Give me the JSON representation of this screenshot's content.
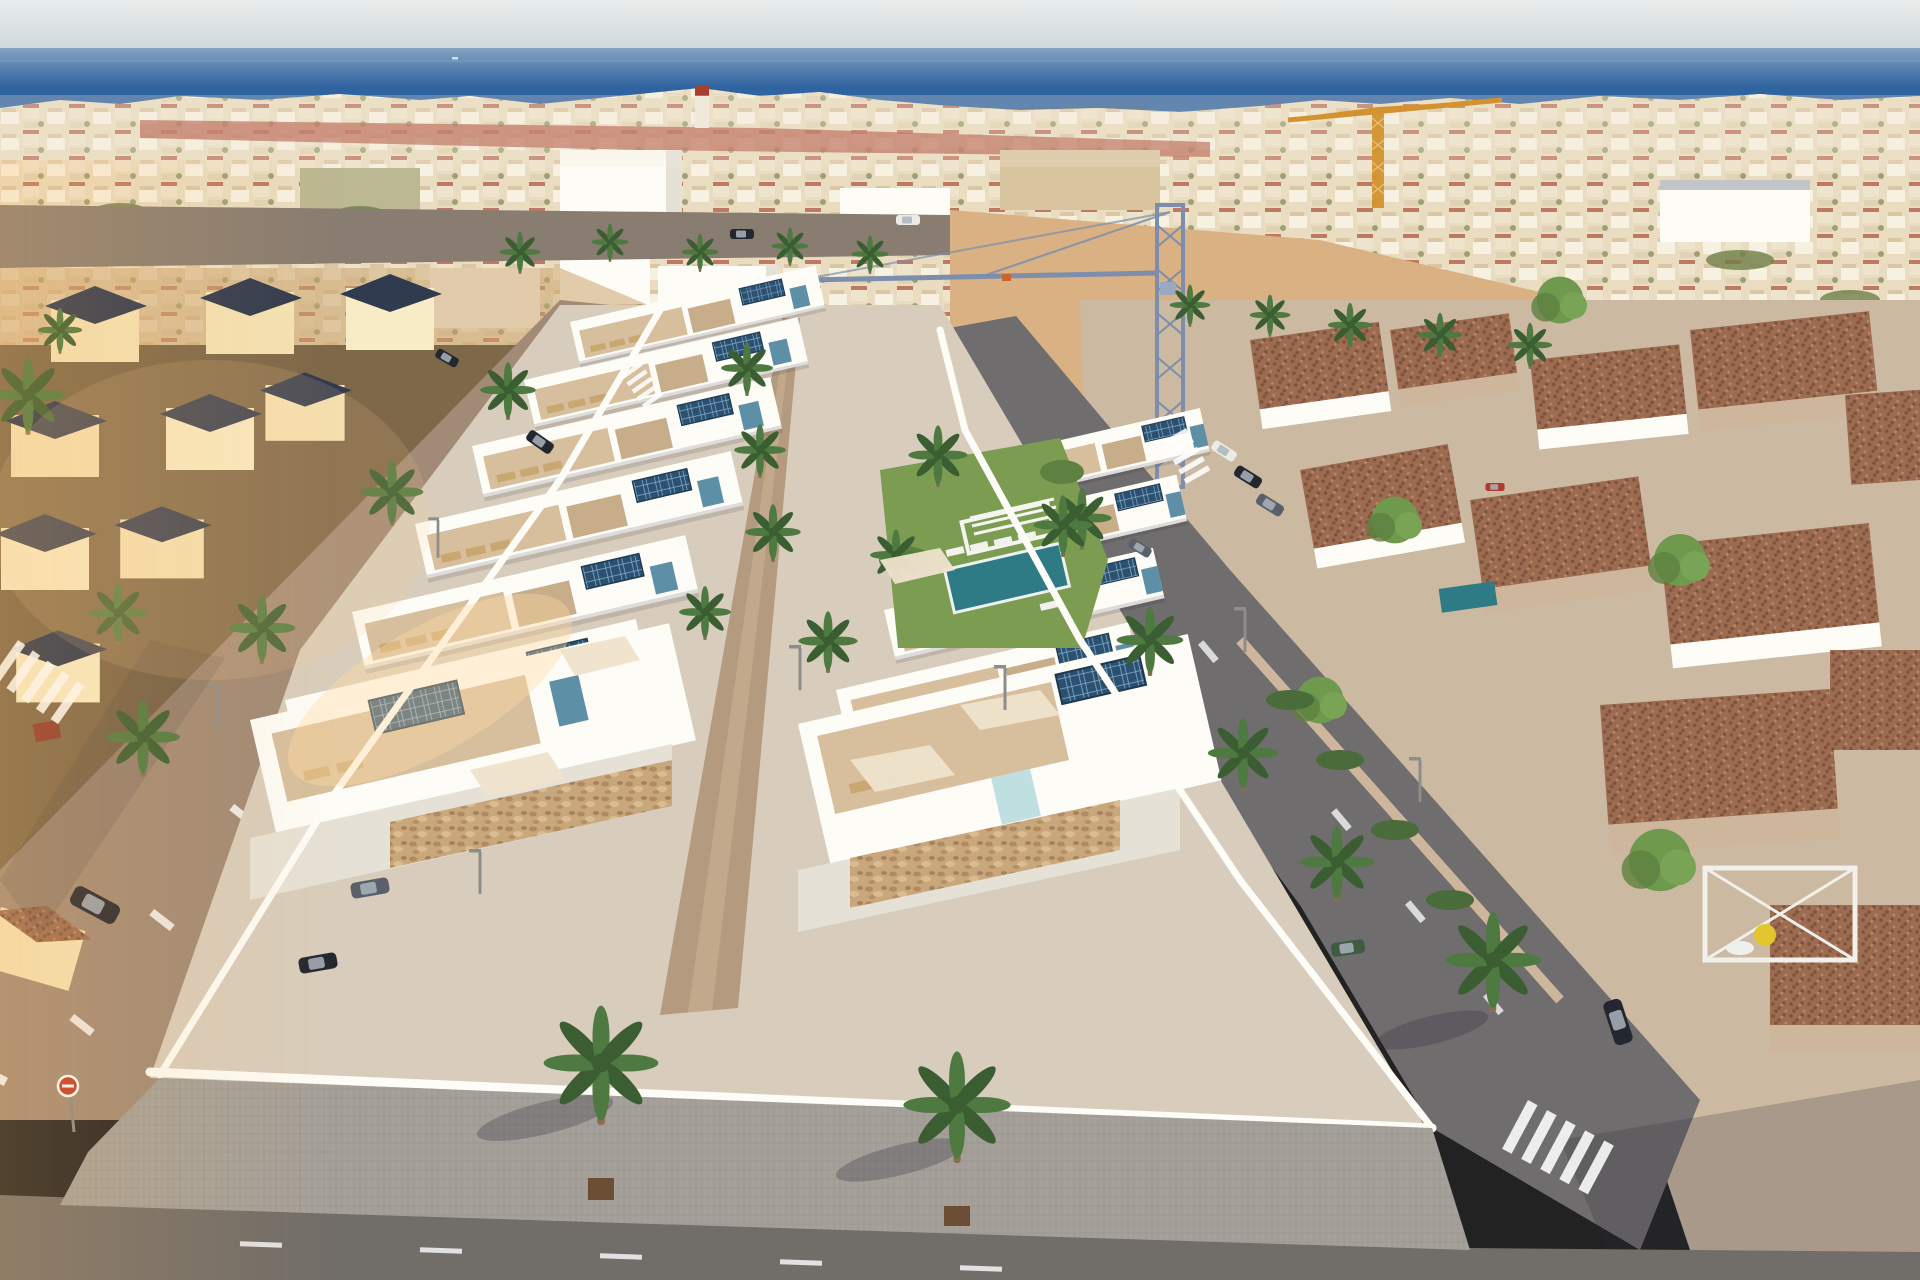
{
  "image": {
    "type": "aerial-drone-photo-with-3d-render",
    "width": 1920,
    "height": 1280
  },
  "scene": {
    "sky": {
      "label": "pale hazy sky"
    },
    "sea": {
      "label": "deep blue sea to horizon"
    },
    "distant_town": {
      "label": "dense coastal town, white walls and terracotta roofs"
    },
    "cranes": [
      {
        "label": "yellow tower crane",
        "color": "#d3922f"
      },
      {
        "label": "blue tower crane",
        "color": "#7d8dac"
      }
    ],
    "new_development": {
      "label": "rows of new white villas, roof terraces, solar panels, teal accents"
    },
    "communal_garden": {
      "label": "lawn, pergola, sun loungers and pool"
    },
    "left_district": {
      "label": "cream villas with dark pyramid roofs"
    },
    "right_district": {
      "label": "tan townhouses with mottled terracotta roofs"
    },
    "streets": {
      "label": "asphalt roads, paver sidewalk, zebra crossings, palm trees, parked cars"
    }
  },
  "inventory": {
    "cranes": 2,
    "zebra_crossings": 5,
    "foreground_palms": 3,
    "parked_cars": 12,
    "pools": 3
  },
  "palette": {
    "sky_top": "#e9eceb",
    "sky_low": "#ccd7dc",
    "sea_far": "#85a2c1",
    "sea_mid": "#2f63a0",
    "sea_near": "#3a6ea9",
    "town_base": "#e9dcc0",
    "town_white": "#f8f3e6",
    "town_tan": "#d9c4a0",
    "town_roof": "#b25a46",
    "town_green": "#6f7f49",
    "sand": "#d9b183",
    "dirt": "#cda273",
    "road_top": "#897d71",
    "road_left": "#a18a76",
    "road_right": "#6f6d6e",
    "asphalt": "#716d69",
    "cobble": "#a5a19a",
    "cobble_line": "#8e8a84",
    "white_wall": "#fdfcf7",
    "white_shade": "#e6e1d6",
    "cream": "#f4e2b4",
    "cream_lit": "#f8ecc6",
    "navy_roof": "#313b50",
    "terracotta": "#9c6b50",
    "terracotta_dark": "#7d533f",
    "tan_wall": "#cdb69b",
    "terrace": "#d7bf9d",
    "terrace_dark": "#c8ad8a",
    "lounger": "#c9a771",
    "solar": "#2c5170",
    "solar_line": "#85aecd",
    "teal": "#5d8fa7",
    "teal_light": "#bfdfe0",
    "pool": "#2f7b85",
    "lawn": "#7c9c52",
    "lawn_dark": "#5e8040",
    "palm_green": "#4e7a41",
    "palm_dark": "#3a5e32",
    "palm_trunk": "#8a6f4e",
    "tree_green": "#6f9a4e",
    "crane_yellow": "#d3922f",
    "crane_blue": "#7d8dac",
    "stone": "#c8a77c",
    "stone_dark": "#b18a5f",
    "car_dark": "#24272f",
    "car_white": "#eceae6",
    "car_green": "#3f5c41",
    "car_gray": "#596069",
    "car_red": "#b03a2e",
    "sign_red": "#c23b2a",
    "shadow": "#2c2836",
    "glare": "#ffd9a0"
  }
}
